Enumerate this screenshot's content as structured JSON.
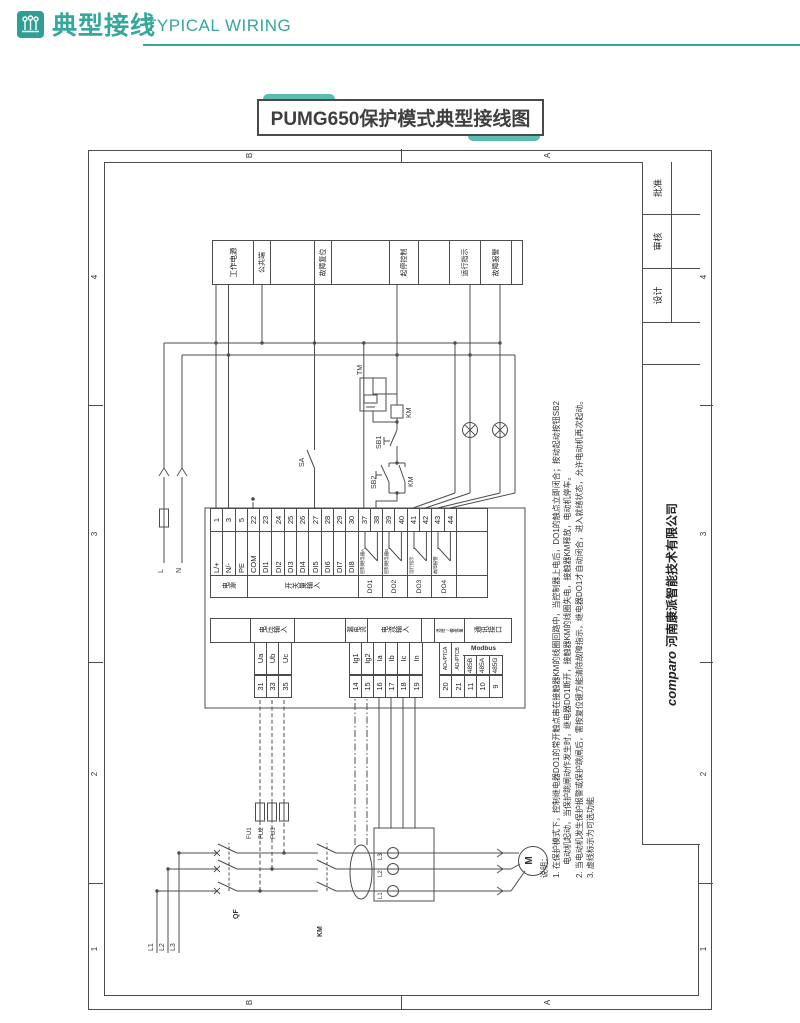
{
  "header": {
    "title_cn": "典型接线",
    "title_en": "TYPICAL WIRING",
    "accent": "#35a79c"
  },
  "sheet_title": "PUMG650保护模式典型接线图",
  "frame": {
    "zone_numbers": [
      "4",
      "3",
      "2",
      "1"
    ],
    "zone_letters": [
      "B",
      "A"
    ]
  },
  "title_block": {
    "design": "设计",
    "check": "审核",
    "approve": "批准",
    "logo": "comparo",
    "company": "河南康派智能技术有限公司"
  },
  "legend": {
    "cells": [
      "工作电源",
      "公共端",
      "故障复位",
      "起停控制",
      "运行指示",
      "故障报警"
    ]
  },
  "device": {
    "power_group": "电源",
    "di_group": "开关量输入",
    "power_terminals": [
      {
        "num": "1",
        "label": "L/+"
      },
      {
        "num": "3",
        "label": "N/-"
      },
      {
        "num": "5",
        "label": "PE"
      }
    ],
    "di_terminals": [
      {
        "num": "22",
        "label": "COM"
      },
      {
        "num": "23",
        "label": "DI1"
      },
      {
        "num": "24",
        "label": "DI2"
      },
      {
        "num": "25",
        "label": "DI3"
      },
      {
        "num": "26",
        "label": "DI4"
      },
      {
        "num": "27",
        "label": "DI5"
      },
      {
        "num": "28",
        "label": "DI6"
      },
      {
        "num": "29",
        "label": "DI7"
      },
      {
        "num": "30",
        "label": "DI8"
      }
    ],
    "do_outputs": [
      {
        "group": "DO1",
        "t1": "37",
        "t2": "38",
        "label": "控制继电器A"
      },
      {
        "group": "DO2",
        "t1": "39",
        "t2": "40",
        "label": "控制继电器B"
      },
      {
        "group": "DO3",
        "t1": "41",
        "t2": "42",
        "label": "运行指示"
      },
      {
        "group": "DO4",
        "t1": "43",
        "t2": "44",
        "label": "故障报警"
      }
    ],
    "voltage_group": "电压输入",
    "voltage_terminals": [
      {
        "num": "31",
        "label": "Ua"
      },
      {
        "num": "33",
        "label": "Ub"
      },
      {
        "num": "35",
        "label": "Uc"
      }
    ],
    "leakage_group": "漏电流",
    "current_group": "电流输入",
    "current_terminals": [
      {
        "num": "14",
        "label": "Ig1"
      },
      {
        "num": "15",
        "label": "Ig2"
      },
      {
        "num": "16",
        "label": "Ia"
      },
      {
        "num": "17",
        "label": "Ib"
      },
      {
        "num": "18",
        "label": "Ic"
      },
      {
        "num": "19",
        "label": "In"
      }
    ],
    "temp_group": "温度/模拟量",
    "comm_group": "通讯接口",
    "modbus": "Modbus",
    "comm_terminals": [
      {
        "num": "20",
        "label": "AO+/PTCA"
      },
      {
        "num": "21",
        "label": "AO-/PTCB"
      },
      {
        "num": "11",
        "label": "485B"
      },
      {
        "num": "10",
        "label": "485A"
      },
      {
        "num": "9",
        "label": "485G"
      }
    ]
  },
  "circuit": {
    "phases": [
      "L1",
      "L2",
      "L3"
    ],
    "breaker": "QF",
    "contactor": "KM",
    "fuses": [
      "FU1",
      "FU2",
      "FU3"
    ],
    "ct_labels": [
      "L1",
      "L2",
      "L3"
    ],
    "motor": "M",
    "line": "L",
    "neutral": "N",
    "stop_button": "SB1",
    "start_button": "SB2",
    "aux_contact": "KM",
    "coil": "KM",
    "suppressor": "TM",
    "di_switch": "SA"
  },
  "notes": {
    "title": "说明：",
    "line1": "1. 在保护模式下，控制继电器DO1的常开触点串在接触器KM的线圈回路中，当控制器上电后，DO1的触点立即闭合；按动起动按钮SB2",
    "line2": "电动机起动，当保护跳闸动作发生时，继电器DO1断开，接触器KM的线圈失电，接触器KM释放，电动机停车。",
    "line3": "2. 当电动机发生保护报警或保护跳闸后，需按复位键方能清除故障指示，继电器DO1才自动闭合，进入就绪状态，允许电动机再次起动。",
    "line4": "3. 虚线标示为可选功能"
  }
}
